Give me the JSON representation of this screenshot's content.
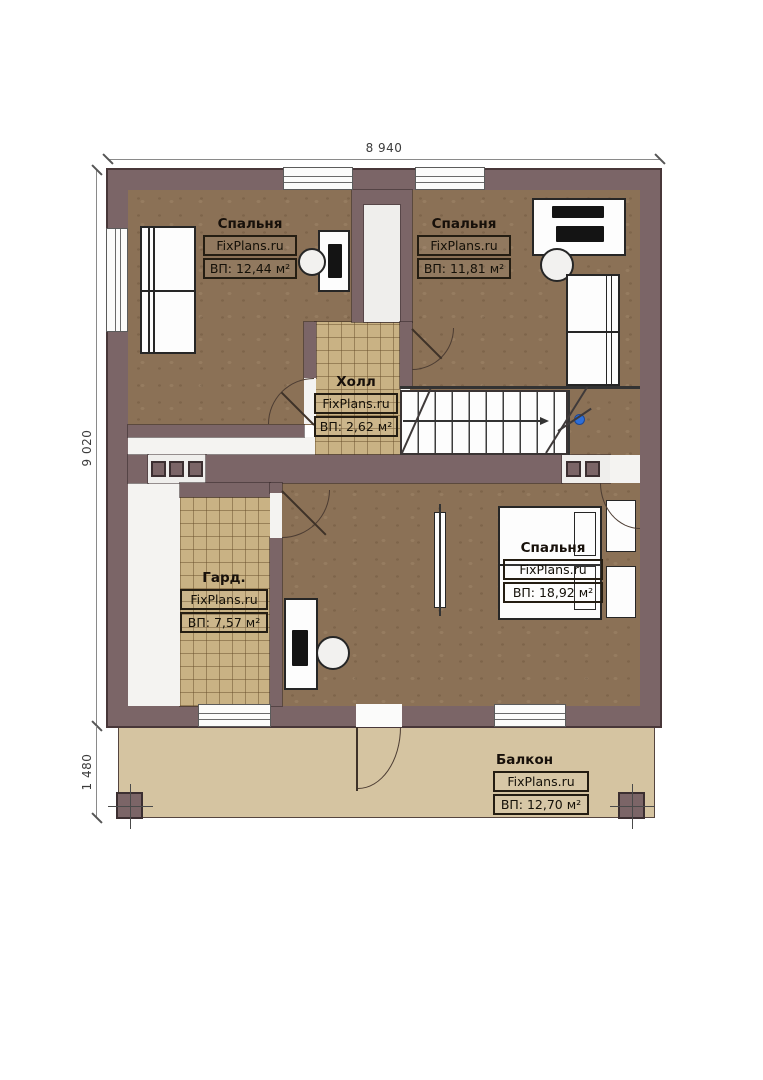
{
  "plan": {
    "title": "Floor plan with balcony",
    "dimensions": {
      "width_top": "8 940",
      "height_left": "9 020",
      "balcony_depth": "1 480"
    },
    "rooms": [
      {
        "id": "bedroom-top-left",
        "name": "Спальня",
        "brand": "FixPlans.ru",
        "area": "ВП: 12,44 м²"
      },
      {
        "id": "bedroom-top-right",
        "name": "Спальня",
        "brand": "FixPlans.ru",
        "area": "ВП: 11,81 м²"
      },
      {
        "id": "hall",
        "name": "Холл",
        "brand": "FixPlans.ru",
        "area": "ВП: 2,62 м²"
      },
      {
        "id": "wardrobe",
        "name": "Гард.",
        "brand": "FixPlans.ru",
        "area": "ВП: 7,57 м²"
      },
      {
        "id": "bedroom-master",
        "name": "Спальня",
        "brand": "FixPlans.ru",
        "area": "ВП: 18,92 м²"
      },
      {
        "id": "balcony",
        "name": "Балкон",
        "brand": "FixPlans.ru",
        "area": "ВП: 12,70 м²"
      }
    ],
    "colors": {
      "wall": "#7b6567",
      "wall_outline": "#483739",
      "floor_wood": "#8b7156",
      "floor_tile": "#c9b284",
      "balcony_floor": "#d5c4a1",
      "stair_marker": "#2e6fd8"
    }
  }
}
